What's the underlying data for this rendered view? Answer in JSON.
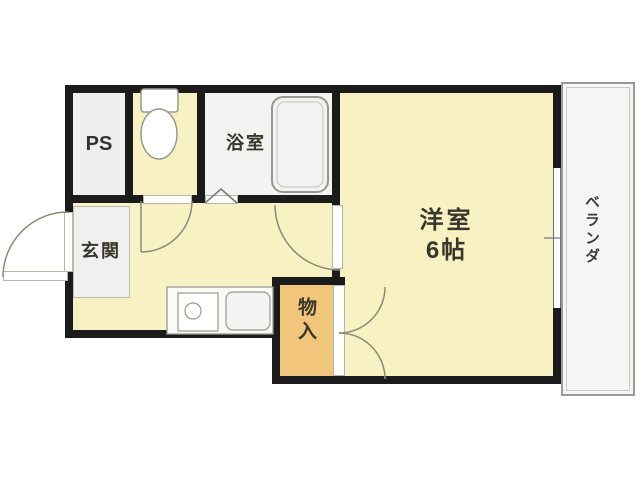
{
  "plan": {
    "type": "apartment-floor-plan",
    "rooms": {
      "ps": {
        "label": "PS"
      },
      "toilet": {
        "label": ""
      },
      "bathroom": {
        "label": "浴室"
      },
      "entrance": {
        "label": "玄関"
      },
      "western_room": {
        "label": "洋室",
        "size": "6帖"
      },
      "storage": {
        "label": "物入"
      },
      "veranda": {
        "label": "ベランダ"
      }
    },
    "fixtures": [
      "toilet-icon",
      "bathtub-icon",
      "stove-icon",
      "sink-icon"
    ],
    "doors": [
      "entrance-swing-door",
      "toilet-swing-door",
      "bathroom-folding-door",
      "western-room-swing-door",
      "storage-double-door",
      "window"
    ],
    "colors": {
      "wall": "#1b1b1b",
      "floor_yellow": "#f8f1c4",
      "floor_orange": "#f2c57c",
      "floor_gray": "#efefef",
      "floor_bath": "#f2f4f2",
      "door_arc": "#8b8b76",
      "fixture_outline": "#999990",
      "text": "#39372b"
    }
  }
}
